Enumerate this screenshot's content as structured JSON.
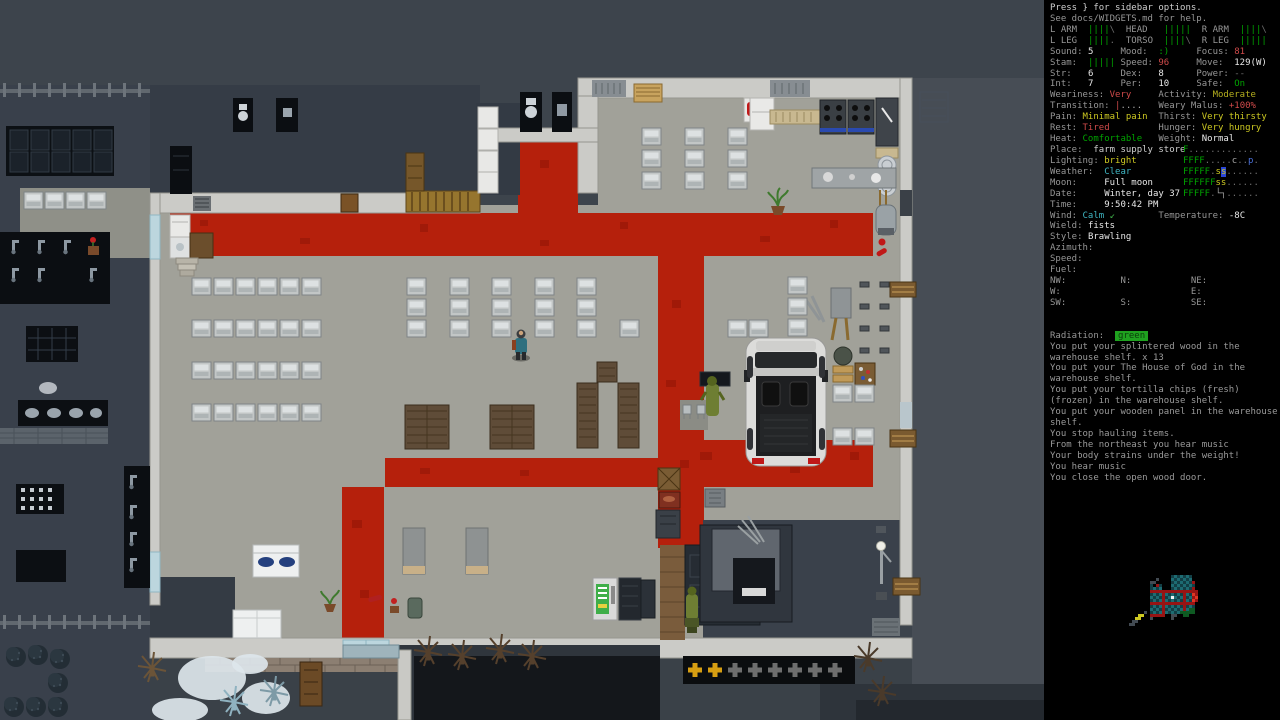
{
  "palette": {
    "text": "#cfcfcf",
    "label": "#969696",
    "white": "#e8e8e8",
    "gray": "#a8a8a8",
    "dkgray": "#6e6e6e",
    "green": "#00a300",
    "ltgreen": "#3fae49",
    "yellow": "#cdc922",
    "olive": "#b4ae1e",
    "red": "#cf4a4a",
    "cyan": "#3fb5c2",
    "blue": "#4a6fd8",
    "msg": "#9a9a9a",
    "badge_bg": "#1fa11f",
    "badge_fg": "#0b3d0b",
    "cursor_bg": "#2a46d8"
  },
  "sidebar": {
    "lines": [
      [
        [
          "Press } for sidebar options.",
          "text"
        ]
      ],
      [
        [
          "See docs/WIDGETS.md for help.",
          "label"
        ]
      ],
      [
        [
          "L ARM  ",
          "label"
        ],
        [
          "||||",
          "green"
        ],
        [
          "\\",
          "dkgray"
        ],
        [
          "  ",
          "label"
        ],
        [
          "HEAD   ",
          "label"
        ],
        [
          "|||||",
          "green"
        ],
        [
          "  ",
          "label"
        ],
        [
          "R ARM  ",
          "label"
        ],
        [
          "||||",
          "green"
        ],
        [
          "\\",
          "dkgray"
        ]
      ],
      [
        [
          "L LEG  ",
          "label"
        ],
        [
          "||||",
          "green"
        ],
        [
          ".",
          "dkgray"
        ],
        [
          "  ",
          "label"
        ],
        [
          "TORSO  ",
          "label"
        ],
        [
          "||||",
          "green"
        ],
        [
          "\\",
          "dkgray"
        ],
        [
          "  ",
          "label"
        ],
        [
          "R LEG  ",
          "label"
        ],
        [
          "|||||",
          "green"
        ]
      ],
      [
        [
          "Sound: ",
          "label"
        ],
        [
          "5",
          "white"
        ],
        [
          "     ",
          "label"
        ],
        [
          "Mood:  ",
          "label"
        ],
        [
          ":)",
          "green"
        ],
        [
          "     ",
          "label"
        ],
        [
          "Focus: ",
          "label"
        ],
        [
          "81",
          "red"
        ]
      ],
      [
        [
          "Stam:  ",
          "label"
        ],
        [
          "|||||",
          "green"
        ],
        [
          " ",
          "label"
        ],
        [
          "Speed: ",
          "label"
        ],
        [
          "96",
          "red"
        ],
        [
          "     ",
          "label"
        ],
        [
          "Move:  ",
          "label"
        ],
        [
          "129(W)",
          "white"
        ]
      ],
      [
        [
          "Str:   ",
          "label"
        ],
        [
          "6",
          "white"
        ],
        [
          "     ",
          "label"
        ],
        [
          "Dex:   ",
          "label"
        ],
        [
          "8",
          "white"
        ],
        [
          "      ",
          "label"
        ],
        [
          "Power: ",
          "label"
        ],
        [
          "--",
          "dkgray"
        ]
      ],
      [
        [
          "Int:   ",
          "label"
        ],
        [
          "7",
          "white"
        ],
        [
          "     ",
          "label"
        ],
        [
          "Per:   ",
          "label"
        ],
        [
          "10",
          "white"
        ],
        [
          "     ",
          "label"
        ],
        [
          "Safe:  ",
          "label"
        ],
        [
          "On",
          "green"
        ]
      ],
      [
        [
          "Weariness: ",
          "label"
        ],
        [
          "Very",
          "red"
        ],
        [
          "     ",
          "label"
        ],
        [
          "Activity: ",
          "label"
        ],
        [
          "Moderate",
          "olive"
        ]
      ],
      [
        [
          "Transition: ",
          "label"
        ],
        [
          "|",
          "red"
        ],
        [
          "....",
          "gray"
        ],
        [
          "   ",
          "label"
        ],
        [
          "Weary Malus: ",
          "label"
        ],
        [
          "+100%",
          "red"
        ]
      ],
      [
        [
          "Pain: ",
          "label"
        ],
        [
          "Minimal pain",
          "yellow"
        ],
        [
          "  ",
          "label"
        ],
        [
          "Thirst: ",
          "label"
        ],
        [
          "Very thirsty",
          "yellow"
        ]
      ],
      [
        [
          "Rest: ",
          "label"
        ],
        [
          "Tired",
          "red"
        ],
        [
          "         ",
          "label"
        ],
        [
          "Hunger: ",
          "label"
        ],
        [
          "Very hungry",
          "yellow"
        ]
      ],
      [
        [
          "Heat: ",
          "label"
        ],
        [
          "Comfortable",
          "green"
        ],
        [
          "   ",
          "label"
        ],
        [
          "Weight: ",
          "label"
        ],
        [
          "Normal",
          "white"
        ]
      ],
      [
        [
          "Place:  ",
          "label"
        ],
        [
          "farm supply store",
          "text"
        ]
      ],
      [
        [
          "Lighting: ",
          "label"
        ],
        [
          "bright",
          "yellow"
        ]
      ],
      [
        [
          "Weather:  ",
          "label"
        ],
        [
          "Clear",
          "cyan"
        ]
      ],
      [
        [
          "Moon:     ",
          "label"
        ],
        [
          "Full moon",
          "white"
        ]
      ],
      [
        [
          "Date:     ",
          "label"
        ],
        [
          "Winter, day 37",
          "white"
        ]
      ],
      [
        [
          "Time:     ",
          "label"
        ],
        [
          "9:50:42 PM",
          "white"
        ]
      ],
      [
        [
          "Wind: ",
          "label"
        ],
        [
          "Calm",
          "cyan"
        ],
        [
          " ↙",
          "ltgreen"
        ],
        [
          "        ",
          "label"
        ],
        [
          "Temperature: ",
          "label"
        ],
        [
          "-8C",
          "white"
        ]
      ],
      [
        [
          "Wield: ",
          "label"
        ],
        [
          "fists",
          "white"
        ]
      ],
      [
        [
          "Style: ",
          "label"
        ],
        [
          "Brawling",
          "white"
        ]
      ],
      [
        [
          "Azimuth:",
          "label"
        ]
      ],
      [
        [
          "Speed:",
          "label"
        ]
      ],
      [
        [
          "Fuel:",
          "label"
        ]
      ],
      [
        [
          "NW:          N:           NE:",
          "label"
        ]
      ],
      [
        [
          "W:                        E:",
          "label"
        ]
      ],
      [
        [
          "SW:          S:           SE:",
          "label"
        ]
      ],
      [
        [
          "",
          "label"
        ]
      ],
      [
        [
          "",
          "label"
        ]
      ],
      [
        [
          "Radiation:  ",
          "label"
        ],
        [
          "green",
          "badge"
        ]
      ],
      [
        [
          "You put your splintered wood in the",
          "msg"
        ]
      ],
      [
        [
          "warehouse shelf. x 13",
          "msg"
        ]
      ],
      [
        [
          "You put your The House of God in the",
          "msg"
        ]
      ],
      [
        [
          "warehouse shelf.",
          "msg"
        ]
      ],
      [
        [
          "You put your tortilla chips (fresh)",
          "msg"
        ]
      ],
      [
        [
          "(frozen) in the warehouse shelf.",
          "msg"
        ]
      ],
      [
        [
          "You put your wooden panel in the warehouse",
          "msg"
        ]
      ],
      [
        [
          "shelf.",
          "msg"
        ]
      ],
      [
        [
          "You stop hauling items.",
          "msg"
        ]
      ],
      [
        [
          "From the northeast you hear music",
          "msg"
        ]
      ],
      [
        [
          "Your body strains under the weight!",
          "msg"
        ]
      ],
      [
        [
          "You hear music",
          "msg"
        ]
      ],
      [
        [
          "You close the open wood door.",
          "msg"
        ]
      ]
    ],
    "overmap": [
      [
        [
          "F",
          "green"
        ],
        [
          ".............",
          "dkgray"
        ]
      ],
      [
        [
          "FFFF",
          "green"
        ],
        [
          ".....",
          "dkgray"
        ],
        [
          "c",
          "gray"
        ],
        [
          "..",
          "dkgray"
        ],
        [
          "p",
          "blue"
        ],
        [
          ".",
          "dkgray"
        ]
      ],
      [
        [
          "FFFFF",
          "green"
        ],
        [
          ".",
          "dkgray"
        ],
        [
          "s",
          "yellow"
        ],
        [
          "s",
          "cursor"
        ],
        [
          "......",
          "dkgray"
        ]
      ],
      [
        [
          "FFFFFF",
          "green"
        ],
        [
          "ss",
          "yellow"
        ],
        [
          "......",
          "dkgray"
        ]
      ],
      [
        [
          "FFFFF",
          "green"
        ],
        [
          ".",
          "dkgray"
        ],
        [
          "└┐",
          "gray"
        ],
        [
          "......",
          "dkgray"
        ]
      ]
    ]
  },
  "minimap": {
    "palette": {
      "t": "#123f46",
      "T": "#1d6b72",
      "r": "#971414",
      "R": "#e03524",
      "w": "#f2f2f2",
      "y": "#cdc922",
      "g": "#0e5a22",
      "k": "#424a52",
      "d": "#262c31",
      "b": "#2a50d0"
    },
    "rows": [
      "............................",
      "...............tTtTtTt.....",
      "..........k....TtTtTtT.....",
      "........kk.....tTtTtTtr....",
      "........t.rt...TtTtTtTt....",
      "........tTtT...tTtTtTtr....",
      "........rrrrrrrrrrrrrrrr...",
      "........tTtTrTtTtTtrTtRr...",
      "........TtTtrtTwTtTrtTrR...",
      "........tTtTrTtTtTtrTtRr...",
      "........rrrrrrrrrrrrrrr....",
      "........tTtTrTtTtTtrtTt....",
      "........TtTtrtTtTtTrTgg....",
      "......k.tTtTrTtTtTggggg....",
      "....yy..rrrrr..kk..gg......",
      "...yy...k......k...........",
      "..kk........................",
      ".kk........................."
    ]
  },
  "map": {
    "metal_shelves": [
      [
        192,
        278
      ],
      [
        214,
        278
      ],
      [
        236,
        278
      ],
      [
        258,
        278
      ],
      [
        280,
        278
      ],
      [
        302,
        278
      ],
      [
        192,
        320
      ],
      [
        214,
        320
      ],
      [
        236,
        320
      ],
      [
        258,
        320
      ],
      [
        280,
        320
      ],
      [
        302,
        320
      ],
      [
        192,
        362
      ],
      [
        214,
        362
      ],
      [
        236,
        362
      ],
      [
        258,
        362
      ],
      [
        280,
        362
      ],
      [
        302,
        362
      ],
      [
        192,
        404
      ],
      [
        214,
        404
      ],
      [
        236,
        404
      ],
      [
        258,
        404
      ],
      [
        280,
        404
      ],
      [
        302,
        404
      ],
      [
        24,
        192
      ],
      [
        45,
        192
      ],
      [
        66,
        192
      ],
      [
        87,
        192
      ],
      [
        407,
        278
      ],
      [
        450,
        278
      ],
      [
        492,
        278
      ],
      [
        535,
        278
      ],
      [
        577,
        278
      ],
      [
        407,
        299
      ],
      [
        450,
        299
      ],
      [
        492,
        299
      ],
      [
        535,
        299
      ],
      [
        577,
        299
      ],
      [
        407,
        320
      ],
      [
        450,
        320
      ],
      [
        492,
        320
      ],
      [
        535,
        320
      ],
      [
        577,
        320
      ],
      [
        620,
        320
      ],
      [
        642,
        128
      ],
      [
        685,
        128
      ],
      [
        728,
        128
      ],
      [
        642,
        150
      ],
      [
        685,
        150
      ],
      [
        728,
        150
      ],
      [
        642,
        172
      ],
      [
        685,
        172
      ],
      [
        728,
        172
      ],
      [
        728,
        320
      ],
      [
        749,
        320
      ],
      [
        788,
        277
      ],
      [
        788,
        298
      ],
      [
        788,
        319
      ],
      [
        833,
        385
      ],
      [
        855,
        385
      ],
      [
        833,
        428
      ],
      [
        855,
        428
      ]
    ],
    "wood_shelves": [
      [
        405,
        405,
        44,
        44
      ],
      [
        490,
        405,
        44,
        44
      ],
      [
        577,
        383,
        21,
        65
      ],
      [
        618,
        383,
        21,
        65
      ],
      [
        597,
        362,
        20,
        20
      ]
    ],
    "pluses": {
      "x0": 695,
      "y": 670,
      "dx": 20,
      "n": 8,
      "gold": 2,
      "gold_color": "#d79e12",
      "gray_color": "#6e6e6e"
    },
    "fences": [
      [
        0,
        86,
        150
      ],
      [
        0,
        618,
        150
      ]
    ],
    "bushes": [
      [
        16,
        657
      ],
      [
        38,
        655
      ],
      [
        60,
        659
      ],
      [
        58,
        683
      ],
      [
        58,
        707
      ],
      [
        14,
        707
      ],
      [
        36,
        707
      ]
    ],
    "snow": [
      [
        212,
        678,
        34,
        22
      ],
      [
        266,
        698,
        24,
        16
      ],
      [
        180,
        710,
        28,
        12
      ],
      [
        250,
        664,
        18,
        10
      ]
    ],
    "trees": [
      [
        152,
        668,
        "#6b5438"
      ],
      [
        274,
        692,
        "#7d9aa6"
      ],
      [
        234,
        702,
        "#8fb2c0"
      ],
      [
        428,
        652,
        "#55402c"
      ],
      [
        462,
        656,
        "#55402c"
      ],
      [
        500,
        650,
        "#55402c"
      ],
      [
        532,
        656,
        "#55402c"
      ],
      [
        868,
        658,
        "#4a3a2a"
      ],
      [
        882,
        692,
        "#4a3a2a"
      ]
    ],
    "faucets_left": [
      [
        12,
        240
      ],
      [
        38,
        240
      ],
      [
        64,
        240
      ],
      [
        90,
        268
      ],
      [
        12,
        268
      ],
      [
        38,
        268
      ],
      [
        64,
        240
      ]
    ],
    "sink_column": [
      [
        130,
        475
      ],
      [
        130,
        505
      ],
      [
        130,
        532
      ],
      [
        130,
        558
      ]
    ],
    "small_items": [
      [
        860,
        282
      ],
      [
        880,
        282
      ],
      [
        860,
        304
      ],
      [
        880,
        304
      ],
      [
        860,
        326
      ],
      [
        880,
        326
      ],
      [
        860,
        348
      ],
      [
        880,
        348
      ]
    ]
  }
}
